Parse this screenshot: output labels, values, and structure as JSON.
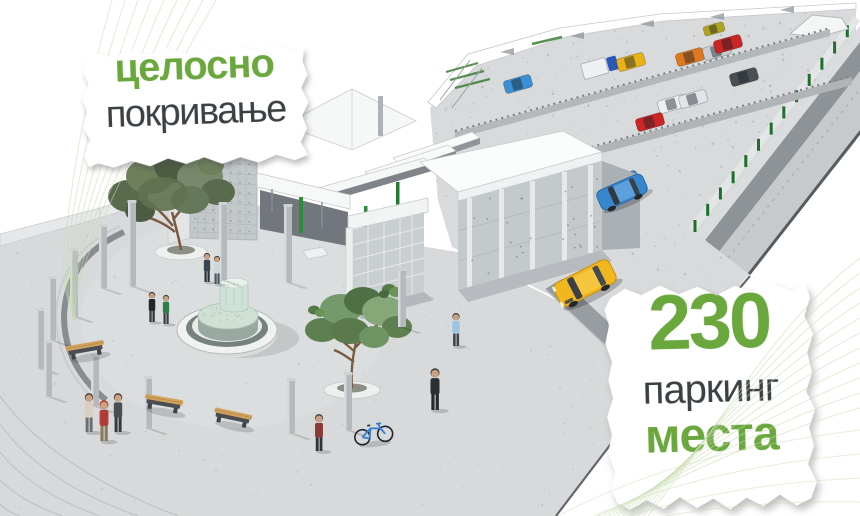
{
  "colors": {
    "accent_green": "#6aa83e",
    "text_dark": "#3b4043",
    "deco_line_green": "#c6dcae",
    "pavement": "#d7d9da",
    "ramp_column_green": "#1e6f2b"
  },
  "callouts": {
    "coverage": {
      "line1": "целосно",
      "line2": "покривање"
    },
    "parking": {
      "number": "230",
      "line1": "паркинг",
      "line2": "места"
    }
  },
  "scene": {
    "description": "3D rendering of a covered market hall with public plaza, fountain, colonnade, and rooftop parking deck with access ramp",
    "parked_cars": [
      {
        "name": "parked-car-blue",
        "color": "#3b8fd4",
        "x": 518,
        "y": 84
      },
      {
        "name": "parked-truck",
        "color": "#2857b8",
        "x": 600,
        "y": 67,
        "truck": true
      },
      {
        "name": "parked-car-yellow",
        "color": "#e8b218",
        "x": 631,
        "y": 62
      },
      {
        "name": "parked-car-orange",
        "color": "#e07820",
        "x": 690,
        "y": 57
      },
      {
        "name": "parked-car-silver",
        "color": "#c9ced2",
        "x": 717,
        "y": 51
      },
      {
        "name": "parked-car-red",
        "color": "#cd2424",
        "x": 728,
        "y": 44
      },
      {
        "name": "parked-car-olive",
        "color": "#b0a41e",
        "x": 714,
        "y": 29,
        "s": 0.75
      },
      {
        "name": "parked-car-dark",
        "color": "#4a4f53",
        "x": 744,
        "y": 77
      },
      {
        "name": "parked-car-white-1",
        "color": "#edeff1",
        "x": 672,
        "y": 104
      },
      {
        "name": "parked-car-white-2",
        "color": "#e2e5e7",
        "x": 693,
        "y": 99
      },
      {
        "name": "parked-car-red-2",
        "color": "#cc2526",
        "x": 650,
        "y": 122
      },
      {
        "name": "parked-car-blue-2",
        "color": "#2f7fd0",
        "x": 624,
        "y": 180
      }
    ],
    "road_cars": [
      {
        "name": "taxi-yellow",
        "color": "#f2b61e"
      },
      {
        "name": "driving-car-blue",
        "color": "#3787cf"
      }
    ],
    "pillars": [
      [
        103,
        226,
        62
      ],
      [
        132,
        202,
        84
      ],
      [
        223,
        204,
        76
      ],
      [
        288,
        206,
        76
      ],
      [
        74,
        250,
        66
      ],
      [
        52,
        278,
        62
      ],
      [
        40,
        310,
        58
      ],
      [
        48,
        342,
        54
      ],
      [
        95,
        356,
        50
      ],
      [
        148,
        378,
        50
      ],
      [
        291,
        380,
        53
      ],
      [
        348,
        374,
        56
      ],
      [
        402,
        270,
        57
      ]
    ],
    "people": [
      {
        "x": 207,
        "y": 282,
        "h": 30,
        "shirt": "#3a4450",
        "pants": "#2e3338"
      },
      {
        "x": 217,
        "y": 284,
        "h": 29,
        "shirt": "#cfd8d8",
        "pants": "#4b5560"
      },
      {
        "x": 152,
        "y": 322,
        "h": 31,
        "shirt": "#22262a",
        "pants": "#33383d"
      },
      {
        "x": 166,
        "y": 324,
        "h": 30,
        "shirt": "#2e7d4f",
        "pants": "#3a3f44"
      },
      {
        "x": 89,
        "y": 432,
        "h": 40,
        "shirt": "#d8cfc0",
        "pants": "#6b6f73"
      },
      {
        "x": 104,
        "y": 441,
        "h": 42,
        "shirt": "#b03a35",
        "pants": "#8a7a5e",
        "cap": "#c03832"
      },
      {
        "x": 118,
        "y": 432,
        "h": 40,
        "shirt": "#4a4e52",
        "pants": "#35393d"
      },
      {
        "x": 319,
        "y": 451,
        "h": 38,
        "shirt": "#8c3a38",
        "pants": "#2f3437"
      },
      {
        "x": 456,
        "y": 346,
        "h": 34,
        "shirt": "#9fc4e0",
        "pants": "#3f444a"
      },
      {
        "x": 435,
        "y": 410,
        "h": 43,
        "shirt": "#2b2f33",
        "pants": "#26292c"
      }
    ],
    "benches": [
      [
        86,
        352,
        -10
      ],
      [
        163,
        406,
        10
      ],
      [
        232,
        420,
        12
      ]
    ]
  }
}
